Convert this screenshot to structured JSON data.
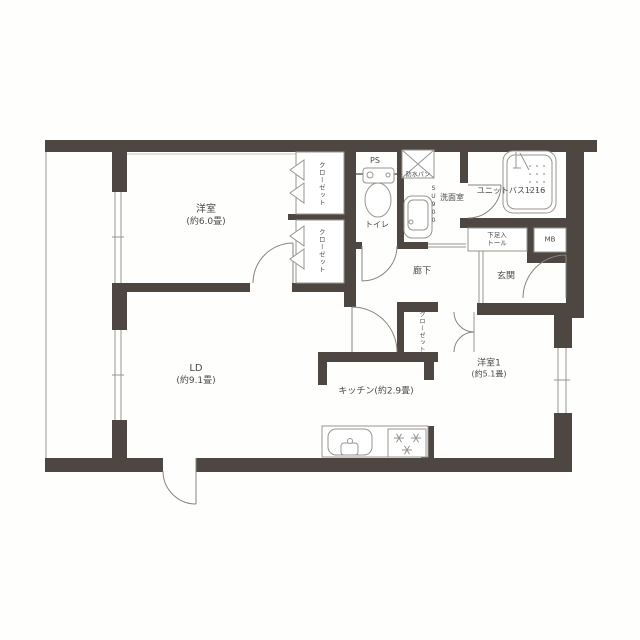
{
  "colors": {
    "wall": "#4e4640",
    "line": "#9a958f",
    "arc": "#8a857f",
    "text": "#4a4a4a"
  },
  "rooms": {
    "bedroom_main": {
      "name": "洋室",
      "size": "(約6.0畳)"
    },
    "living_dining": {
      "name": "LD",
      "size": "(約9.1畳)"
    },
    "kitchen": {
      "name": "キッチン(約2.9畳)"
    },
    "bedroom1": {
      "name": "洋室1",
      "size": "(約5.1畳)"
    },
    "entrance": {
      "name": "玄関"
    },
    "hallway": {
      "name": "廊下"
    },
    "toilet": {
      "name": "トイレ"
    },
    "washroom": {
      "name": "洗面室"
    },
    "unit_bath": {
      "name": "ユニットバス1216"
    }
  },
  "features": {
    "pipe_space": "PS",
    "meter_box": "MB",
    "washer_pan": "防水パン",
    "vanity_model": "SU900",
    "shoe_cabinet_line1": "下足入",
    "shoe_cabinet_line2": "トール",
    "closet": "クローゼット"
  }
}
